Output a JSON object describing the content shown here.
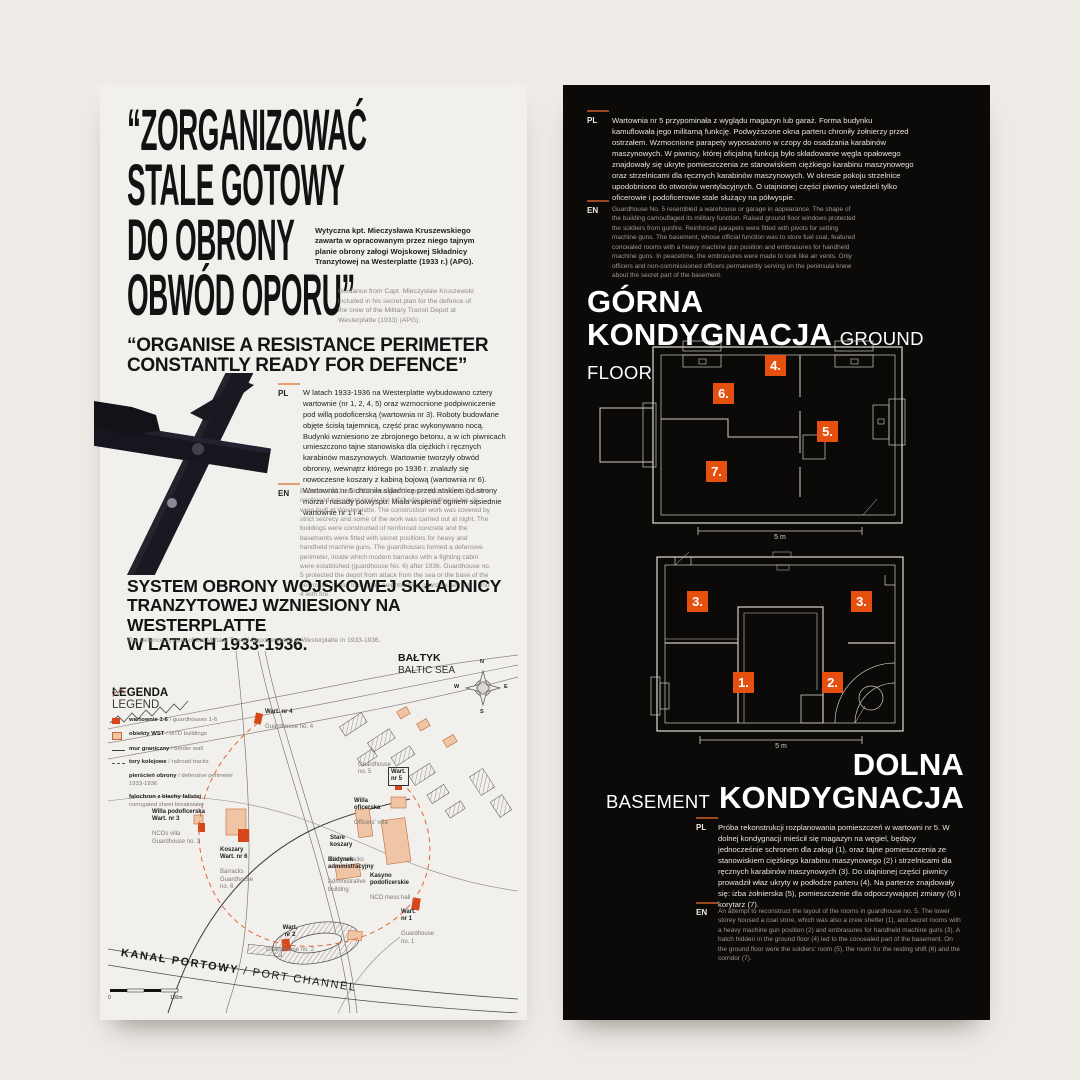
{
  "page": {
    "bg": "#efebe7",
    "accent_orange": "#e5500f",
    "panel_dark": "#0c0a08",
    "panel_light": "#f2f0ec"
  },
  "left": {
    "headline": {
      "lines": [
        "“ZORGANIZOWAĆ",
        "STALE GOTOWY",
        "DO OBRONY",
        "OBWÓD OPORU”"
      ]
    },
    "caption_pl": "Wytyczna kpt. Mieczysława Kruszewskiego zawarta w opracowanym przez niego tajnym planie obrony załogi Wojskowej Składnicy Tranzytowej na Westerplatte (1933 r.) (APG).",
    "caption_en": "Guidance from Capt. Mieczysław Kruszewski included in his secret plan for the defence of the crew of the Military Transit Depot at Westerplatte (1933) (APG).",
    "subtitle": {
      "lines": [
        "“ORGANISE A RESISTANCE PERIMETER",
        "CONSTANTLY READY FOR DEFENCE”"
      ]
    },
    "intro": {
      "pl_label": "PL",
      "pl_text": "W latach 1933-1936 na Westerplatte wybudowano cztery wartownie (nr 1, 2, 4, 5) oraz wzmocnione podpiwniczenie pod willą podoficerską (wartownia nr 3). Roboty budowlane objęte ścisłą tajemnicą, część prac wykonywano nocą. Budynki wzniesiono ze zbrojonego betonu, a w ich piwnicach umieszczono tajne stanowiska dla ciężkich i ręcznych karabinów maszynowych. Wartownie tworzyły obwód obronny, wewnątrz którego po 1936 r. znalazły się nowoczesne koszary z kabiną bojową (wartownia nr 6). Wartownia nr 5 chroniła składnicę przed atakiem od strony morza i nasady półwyspu. Miała wspierać ogniem sąsiednie wartownie nr 1 i 4.",
      "en_label": "EN",
      "en_text": "Between 1933 and 1936, four guardhouses (No. 1, 2, 4, 5) and a reinforced basement under the NCO villa (guardhouse No. 3) were built at Westerplatte. The construction work was covered by strict secrecy and some of the work was carried out at night. The buildings were constructed of reinforced concrete and the basements were fitted with secret positions for heavy and handheld machine guns. The guardhouses formed a defensive perimeter, inside which modern barracks with a fighting cabin were established (guardhouse No. 6) after 1936. Guardhouse no. 5 protected the depot from attack from the sea or the base of the peninsula. It was to support neighbouring guardhouses no. 1 and 4 with fire."
    },
    "section": {
      "title_lines": [
        "SYSTEM OBRONY WOJSKOWEJ SKŁADNICY",
        "TRANZYTOWEJ WZNIESIONY NA WESTERPLATTE",
        "W LATACH 1933-1936."
      ],
      "subtitle": "The defence system of the Military Transit Depot erected at Westerplatte in 1933-1936."
    },
    "map": {
      "legend": {
        "title_pl": "LEGENDA",
        "title_en": "LEGEND",
        "items": [
          {
            "pl": "wartownie 1-6",
            "en": " / guardhouses 1-6"
          },
          {
            "pl": "obiekty WST",
            "en": " / MTD buildings"
          },
          {
            "pl": "mur graniczny",
            "en": " / border wall"
          },
          {
            "pl": "tory kolejowe",
            "en": " / railroad tracks"
          },
          {
            "pl": "pierścień obrony",
            "en": " / defensive perimeter 1933-1936"
          },
          {
            "pl": "falochron z blachy falistej",
            "en": "corrugated sheet breakwater"
          }
        ]
      },
      "sea_pl": "BAŁTYK",
      "sea_en": "BALTIC SEA",
      "compass": {
        "n": "N",
        "e": "E",
        "s": "S",
        "w": "W"
      },
      "labels": [
        {
          "pl": "Wart. nr 4",
          "en": "Guardhouse no. 4"
        },
        {
          "pl": "Wart.\nnr 5",
          "en": "Guardhouse\nno. 5"
        },
        {
          "pl": "Willa\noficerska",
          "en": "Officers' villa"
        },
        {
          "pl": "Willa podoficerska\nWart. nr 3",
          "en": "NCOs villa\nGuardhouse no. 3"
        },
        {
          "pl": "Koszary\nWart. nr 6",
          "en": "Barracks\nGuardhouse\nno. 6"
        },
        {
          "pl": "Stare\nkoszary",
          "en": "Old barracks"
        },
        {
          "pl": "Budynek\nadministracyjny",
          "en": "Administrative\nbuilding"
        },
        {
          "pl": "Kasyno\npodoficerskie",
          "en": "NCO mess hall"
        },
        {
          "pl": "Wart.\nnr 2",
          "en": "Guardhouse no. 2"
        },
        {
          "pl": "Wart.\nnr 1",
          "en": "Guardhouse\nno. 1"
        }
      ],
      "channel_pl": "KANAŁ PORTOWY",
      "channel_en": " / PORT CHANNEL",
      "scale_start": "0",
      "scale_end": "100m"
    }
  },
  "right": {
    "top": {
      "pl_label": "PL",
      "pl_text": "Wartownia nr 5 przypominała z wyglądu magazyn lub garaż. Forma budynku kamuflowała jego militarną funkcję. Podwyższone okna parteru chroniły żołnierzy przed ostrzałem. Wzmocnione parapety wyposażono w czopy do osadzania karabinów maszynowych. W piwnicy, której oficjalną funkcją było składowanie węgla opałowego znajdowały się ukryte pomieszczenia ze stanowiskiem ciężkiego karabinu maszynowego oraz strzelnicami dla ręcznych karabinów maszynowych. W okresie pokoju strzelnice upodobniono do otworów wentylacyjnych. O utajnionej części piwnicy wiedzieli tylko oficerowie i podoficerowie stale służący na półwyspie.",
      "en_label": "EN",
      "en_text": "Guardhouse No. 5 resembled a warehouse or garage in appearance. The shape of the building camouflaged its military function. Raised ground floor windows protected the soldiers from gunfire. Reinforced parapets were fitted with pivots for setting machine guns. The basement, whose official function was to store fuel coal, featured concealed rooms with a heavy machine gun position and embrasures for handheld machine guns. In peacetime, the embrasures were made to look like air vents. Only officers and non-commissioned officers permanently serving on the peninsula knew about the secret part of the basement."
    },
    "ground": {
      "title_pl_line1": "GÓRNA",
      "title_pl_line2": "KONDYGNACJA",
      "title_en": "GROUND FLOOR",
      "markers": [
        "4.",
        "5.",
        "6.",
        "7."
      ],
      "scale": "5 m"
    },
    "basement": {
      "title_pl_line1": "DOLNA",
      "title_pl_line2": "KONDYGNACJA",
      "title_en": "BASEMENT",
      "markers": [
        "1.",
        "2.",
        "3.",
        "3."
      ],
      "scale": "5 m"
    },
    "bottom": {
      "pl_label": "PL",
      "pl_text": "Próba rekonstrukcji rozplanowania pomieszczeń w wartowni nr 5. W dolnej kondygnacji mieścił się magazyn na węgiel, będący jednocześnie schronem dla załogi (1), oraz tajne pomieszczenia ze stanowiskiem ciężkiego karabinu maszynowego (2) i strzelnicami dla ręcznych karabinów maszynowych (3). Do utajnionej części piwnicy prowadził właz ukryty w podłodze parteru (4). Na parterze znajdowały się: izba żołnierska (5), pomieszczenie dla odpoczywającej zmiany (6) i korytarz (7).",
      "en_label": "EN",
      "en_text": "An attempt to reconstruct the layout of the rooms in guardhouse no. 5. The lower storey housed a coal store, which was also a crew shelter (1), and secret rooms with a heavy machine gun position (2) and embrasures for handheld machine guns (3). A hatch hidden in the ground floor (4) led to the concealed part of the basement. On the ground floor were the soldiers' room (5), the room for the resting shift (6) and the corridor (7)."
    }
  }
}
